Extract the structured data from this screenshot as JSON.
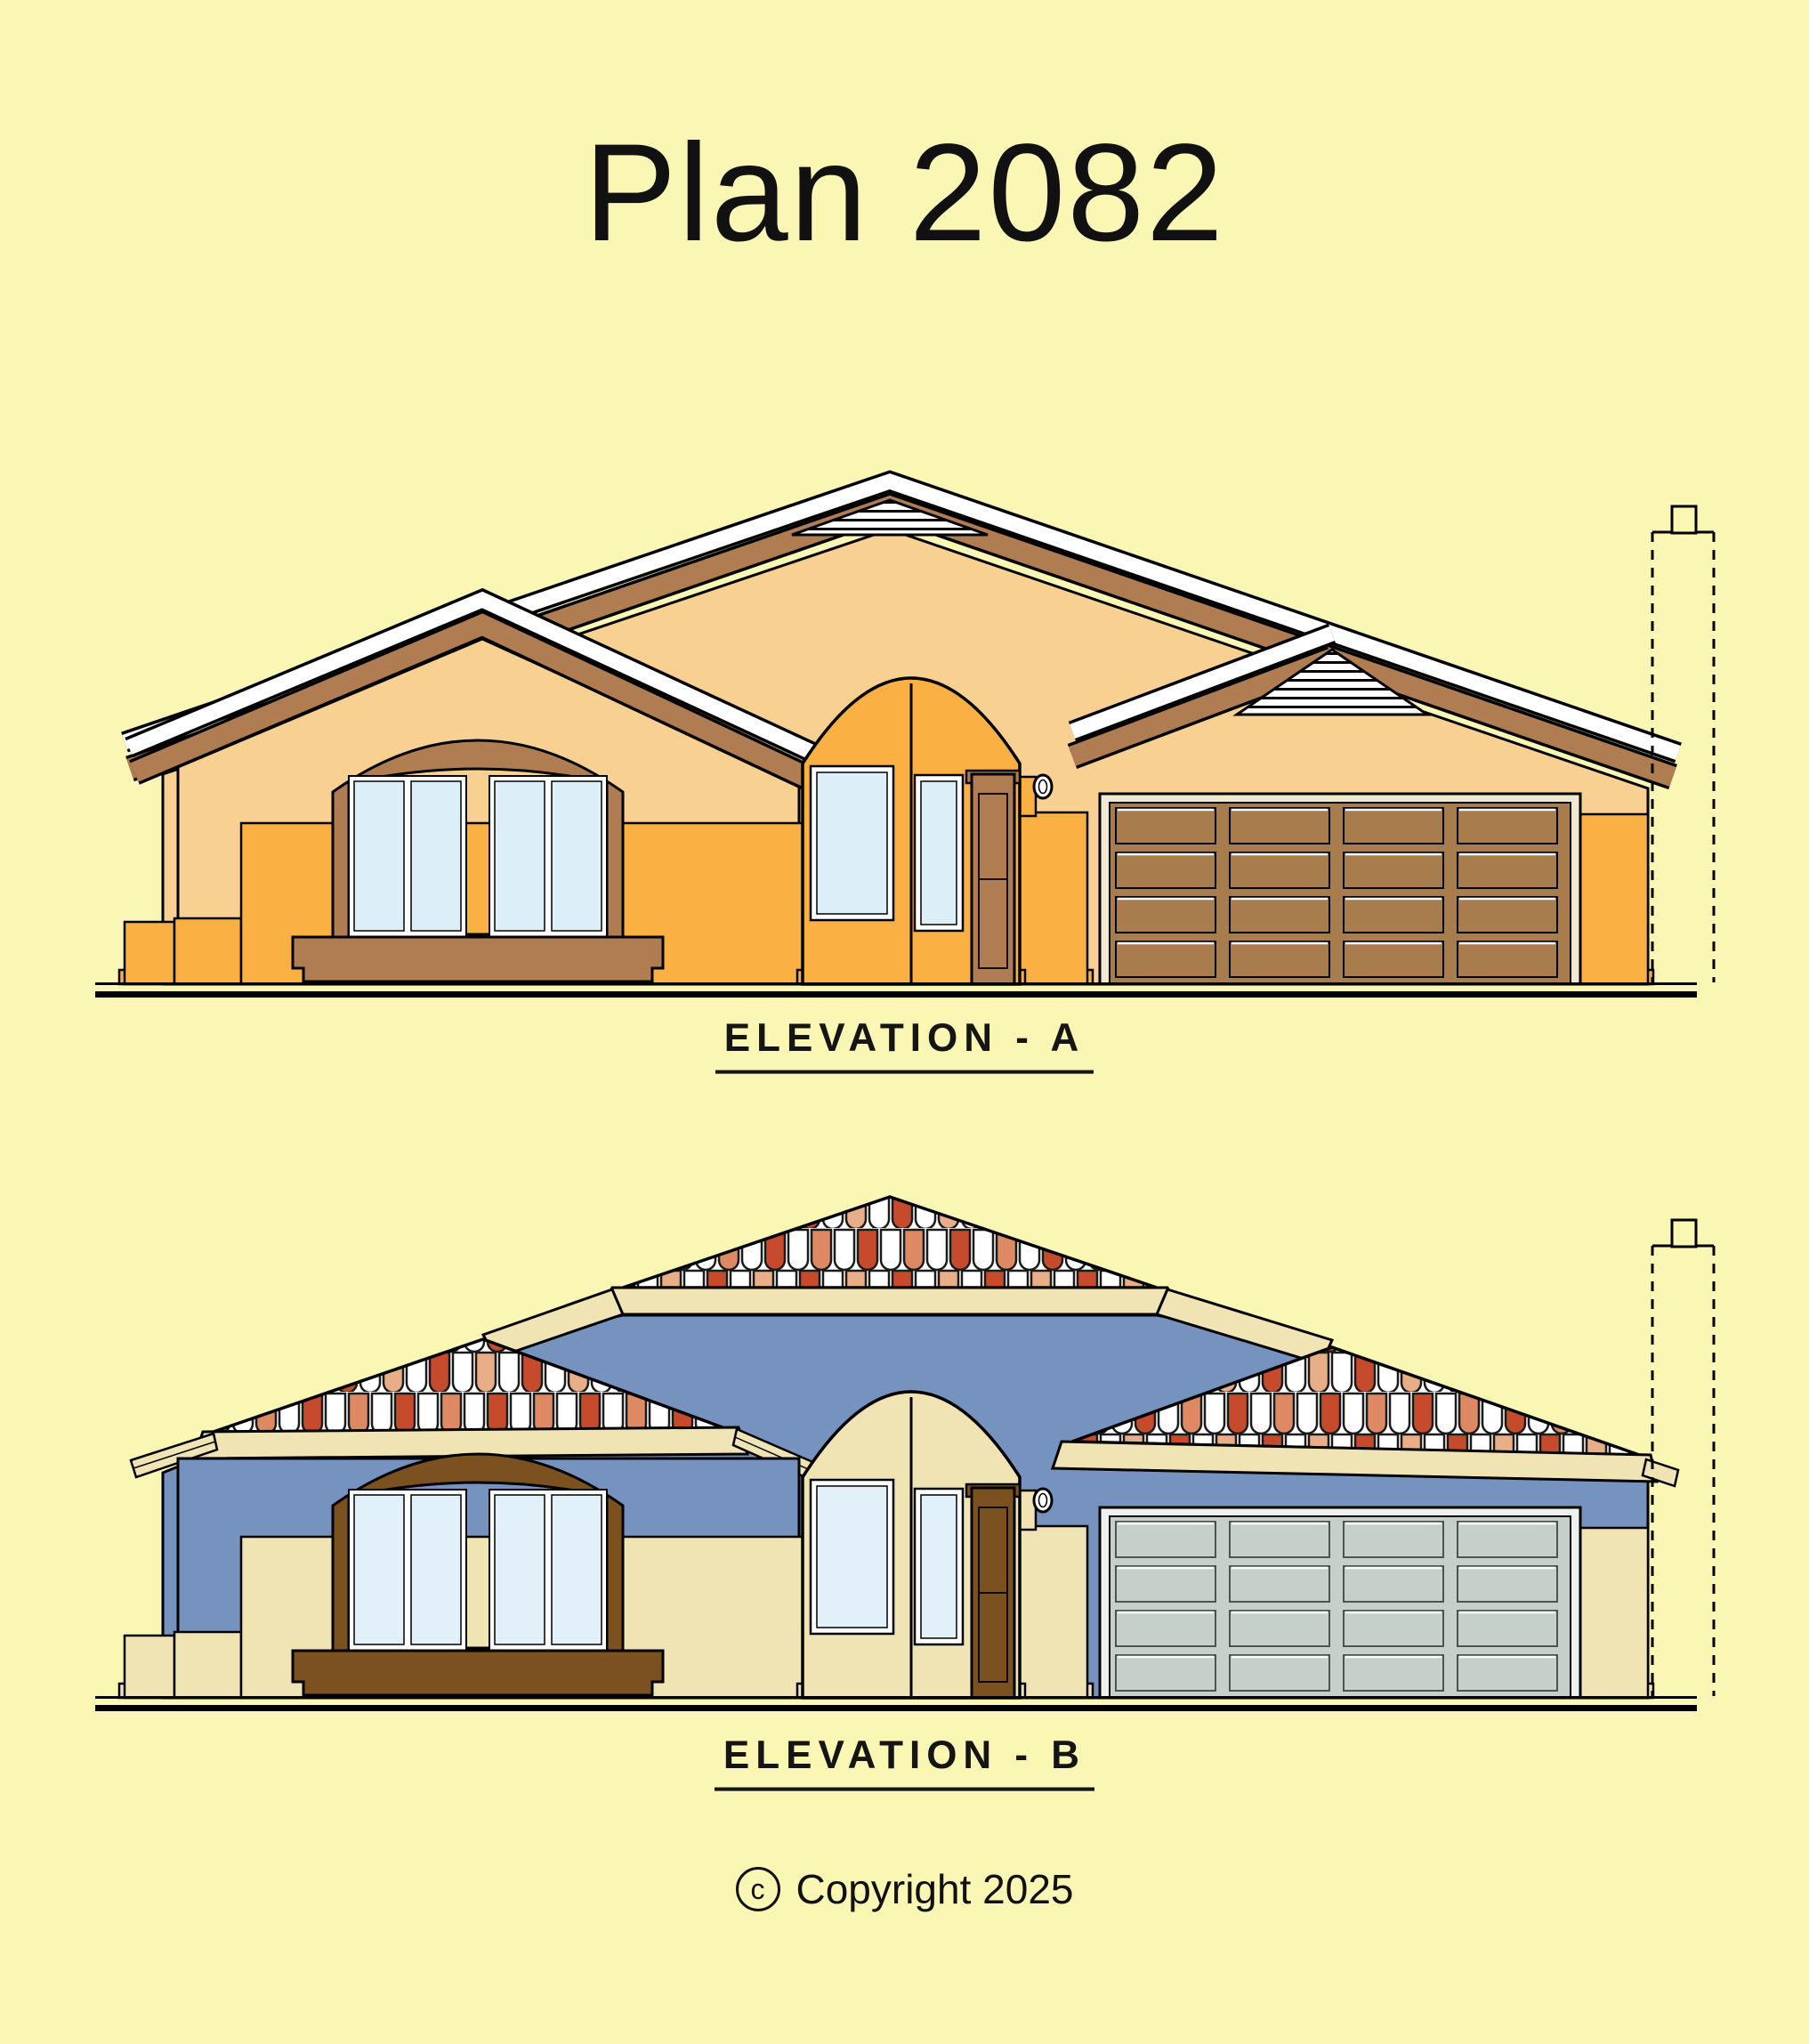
{
  "title": "Plan 2082",
  "elevations": [
    {
      "id": "A",
      "label": "ELEVATION - A"
    },
    {
      "id": "B",
      "label": "ELEVATION - B"
    }
  ],
  "copyright": {
    "symbol": "c",
    "text": "Copyright 2025"
  },
  "colors": {
    "background": "#FAF6B4",
    "line": "#000000",
    "elevation_a": {
      "wall": "#F8D192",
      "accent": "#FBB044",
      "trim": "#B07D53",
      "door": "#A97C4E",
      "garage_frame": "#F1E8D2",
      "glass": "#DCEEF7"
    },
    "elevation_b": {
      "wall": "#7692BE",
      "trim": "#F0E4B4",
      "wood": "#7B5120",
      "garage": "#C6D0CB",
      "garage_frame": "#EDF0EC",
      "glass": "#E2F1F9",
      "tile_red": "#C64B2C",
      "tile_salmon": "#DD8A64",
      "tile_light": "#E8AE88",
      "tile_white": "#FFFFFF"
    }
  }
}
